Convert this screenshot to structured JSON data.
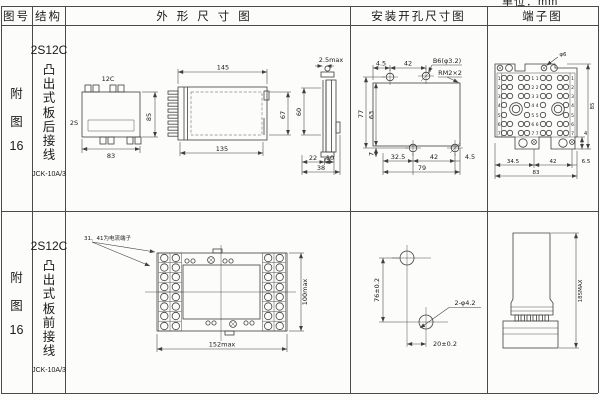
{
  "unit": "单位：mm",
  "headers": {
    "fig": "图号",
    "structure": "结构",
    "outline": "外形尺寸图",
    "mounting": "安装开孔尺寸图",
    "terminal": "端子图"
  },
  "row1": {
    "fig": {
      "c1": "附",
      "c2": "图",
      "c3": "16"
    },
    "model": "2S12C",
    "wiring": "凸出式板后接线",
    "type": "JCK-10A/3",
    "topview": {
      "t": "12C",
      "l": "2S",
      "h": "85",
      "w": "83"
    },
    "side": {
      "top": "145",
      "bottom": "135",
      "right": "67"
    },
    "edge": {
      "top": "2.5max",
      "left": "60",
      "b1": "22",
      "b2": "10",
      "b3": "38"
    },
    "mount": {
      "t1": "4.5",
      "t2": "42",
      "screw": "B6(φ3.2)",
      "thread": "RM2×2",
      "l1": "77",
      "l2": "63",
      "bl": "7",
      "b1": "32.5",
      "b2": "42",
      "b3": "4.5",
      "b4": "79"
    },
    "term": {
      "label": "φ6",
      "left": [
        "1",
        "2",
        "3",
        "4",
        "5",
        "6",
        "7"
      ],
      "center": [
        "1 1",
        "2 2",
        "3 3",
        "4 4",
        "5 5",
        "6 6",
        "7 7"
      ],
      "right": [
        "1",
        "2",
        "3",
        "4",
        "5",
        "6",
        "7"
      ],
      "r1": "85",
      "r2": "4",
      "b1": "34.5",
      "b2": "42",
      "b3": "6.5",
      "b4": "83"
    }
  },
  "row2": {
    "fig": {
      "c1": "附",
      "c2": "图",
      "c3": "16"
    },
    "model": "2S12C",
    "wiring": "凸出式板前接线",
    "type": "JCK-10A/3",
    "note": "31、41为电流端子",
    "front": {
      "h": "100max",
      "w": "152max"
    },
    "mount": {
      "v": "76±0.2",
      "h": "20±0.2",
      "label": "2-φ4.2"
    },
    "side": {
      "h": "185MAX"
    }
  }
}
